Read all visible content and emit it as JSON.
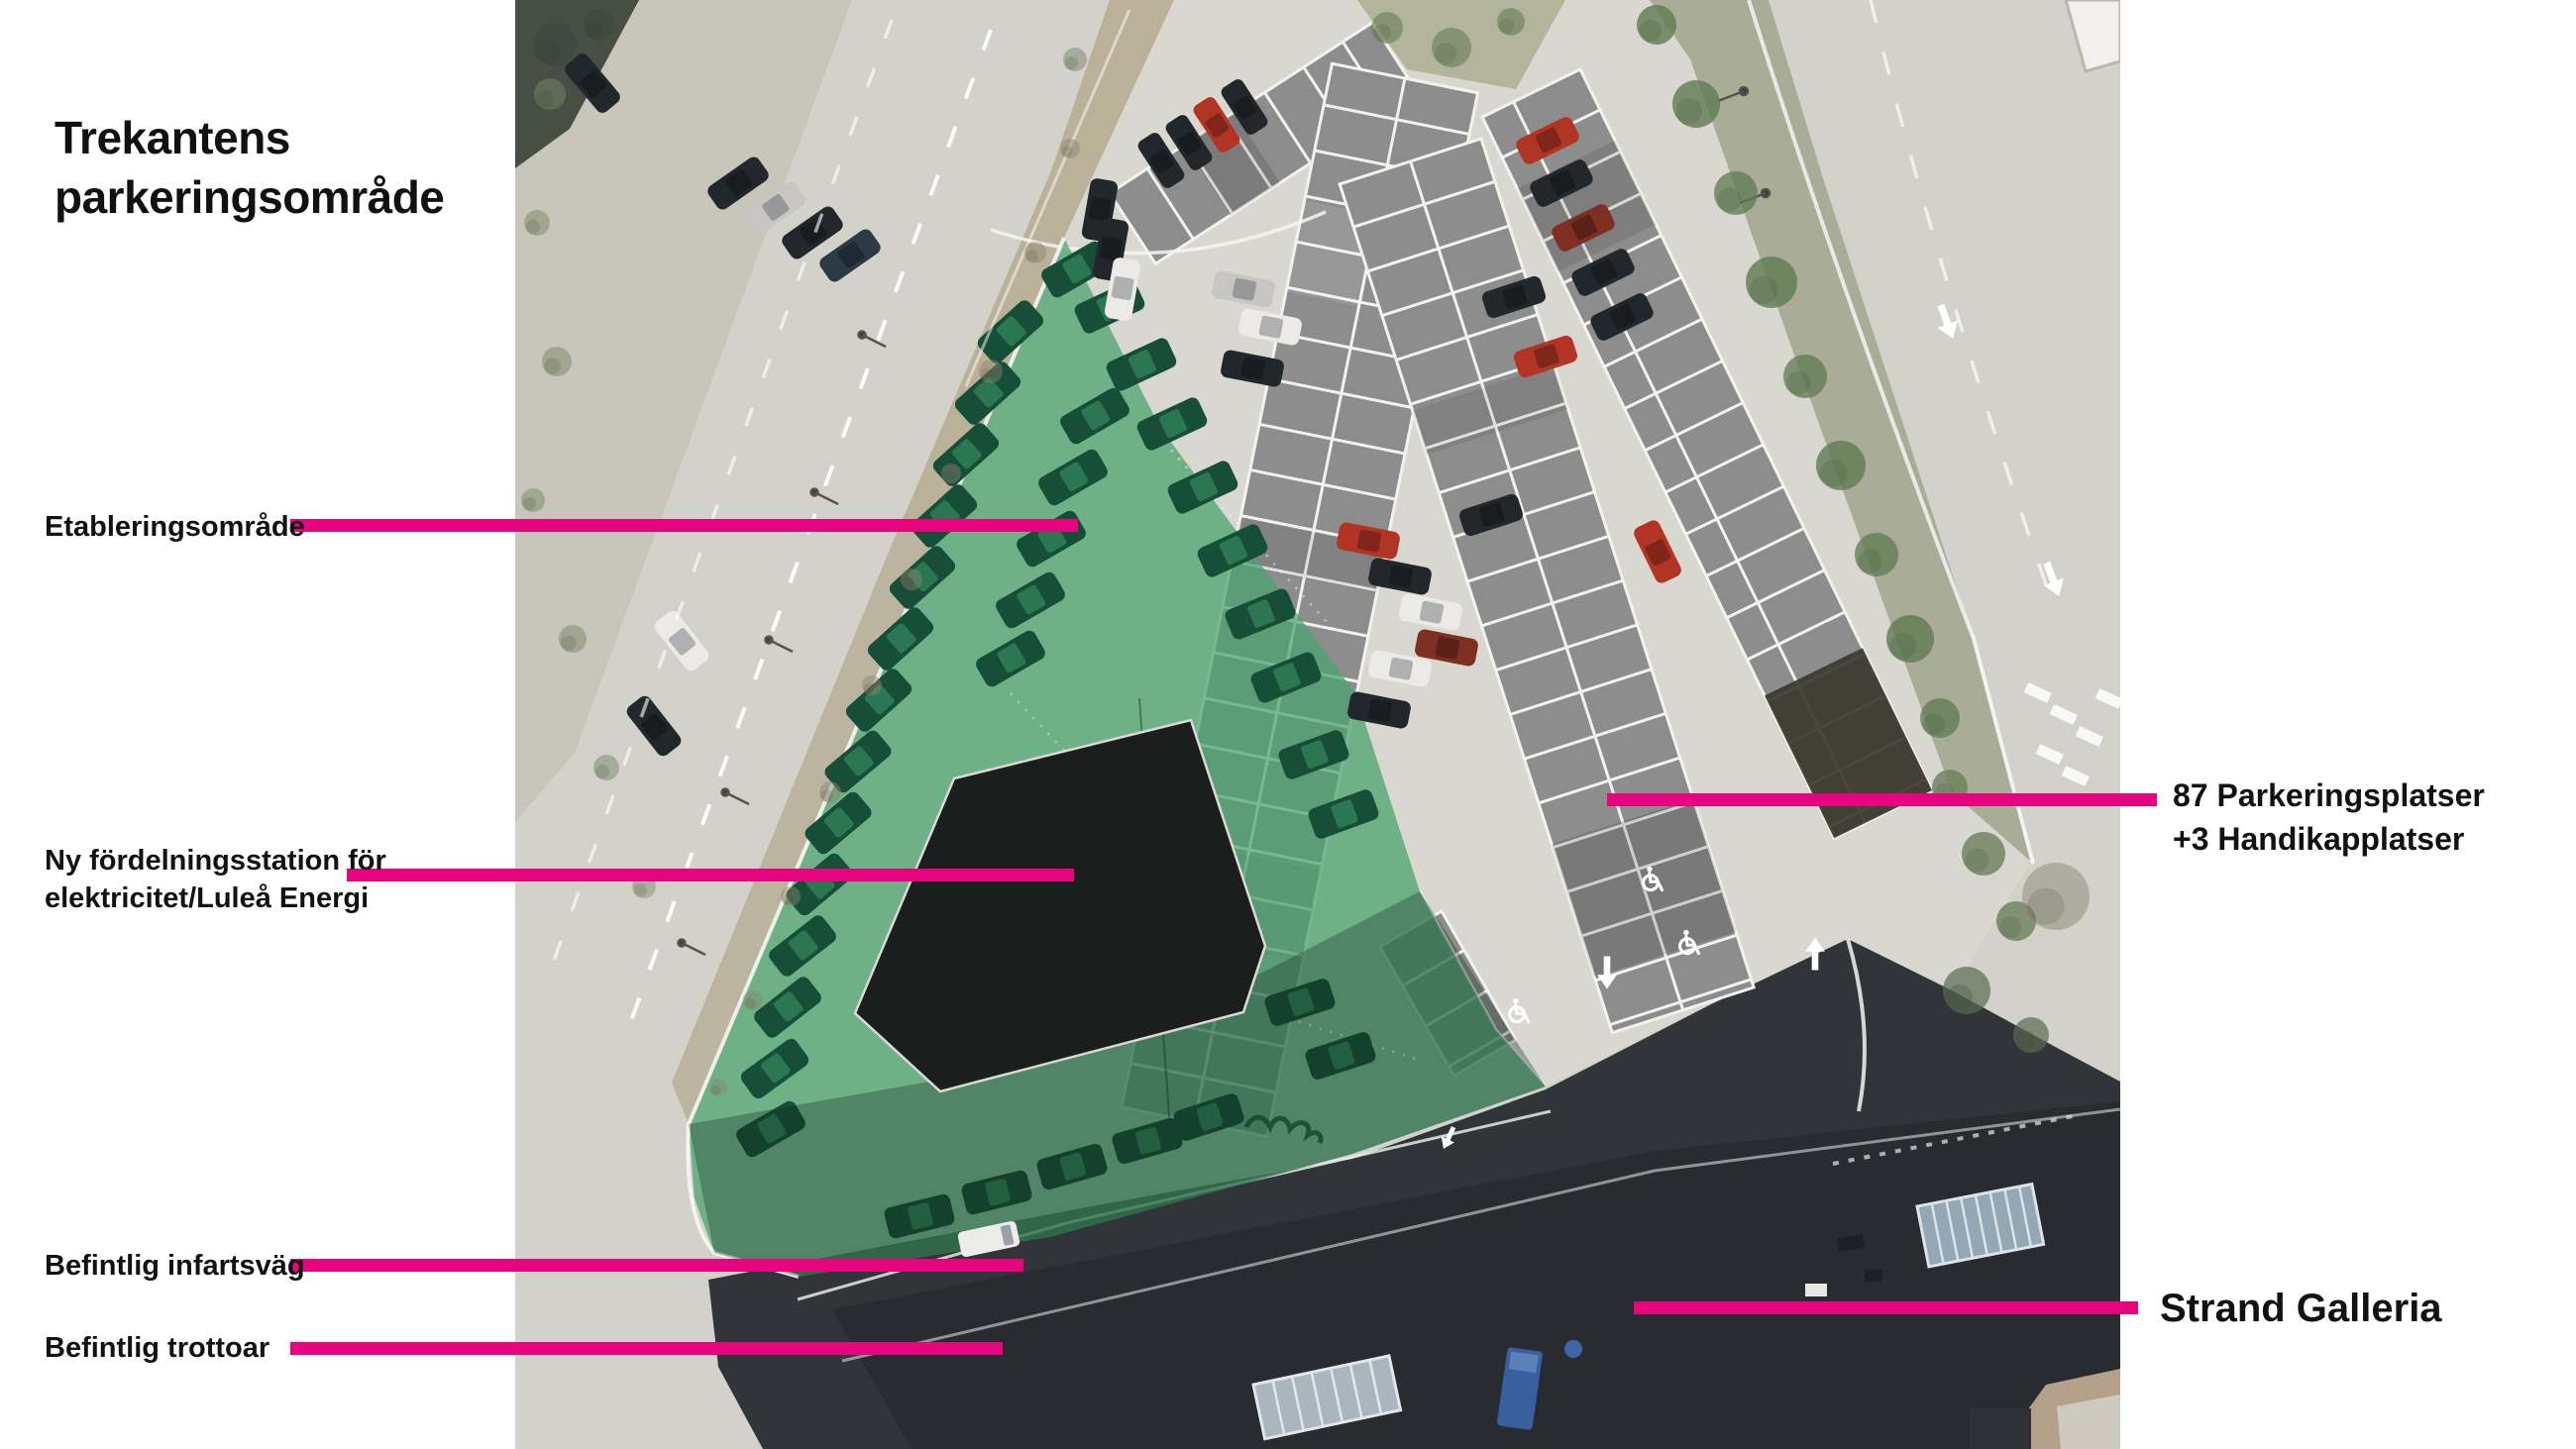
{
  "title": "Trekantens parkeringsområde",
  "accent_color": "#e6057f",
  "annotations": {
    "etableringsomrade": {
      "label": "Etableringsområde"
    },
    "fordelningsstation": {
      "label_line1": "Ny fördelningsstation för",
      "label_line2": "elektricitet/Luleå Energi"
    },
    "infartsvag": {
      "label": "Befintlig infartsväg"
    },
    "trottoar": {
      "label": "Befintlig trottoar"
    },
    "parkeringsplatser": {
      "label_line1": "87 Parkeringsplatser",
      "label_line2": "+3 Handikapplatser"
    },
    "strand_galleria": {
      "label": "Strand Galleria"
    }
  },
  "map": {
    "type": "aerial-site-plan",
    "overlay_colors": {
      "etableringsomrade_green": "#47a36d",
      "fordelningsstation_black": "#1c1e1d",
      "parking_grid_gray": "#8d8d8d"
    }
  }
}
